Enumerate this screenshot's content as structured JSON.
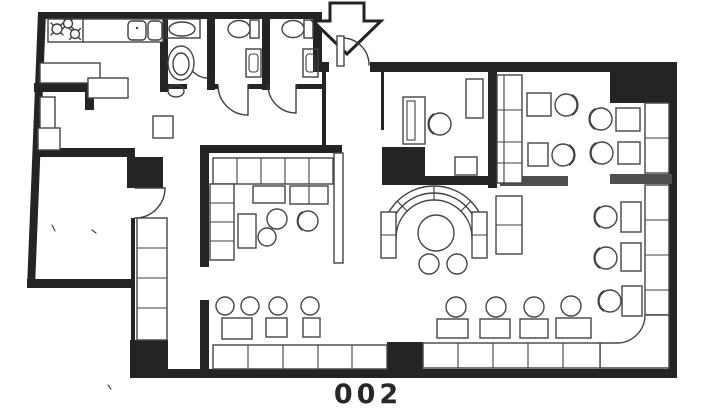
{
  "plan": {
    "label": "002",
    "colors": {
      "paper": "#ffffff",
      "wall": "#242424",
      "line": "#3f3f3f",
      "partition": "#4f4f4f"
    },
    "icons": {
      "entrance_arrow": "entrance-arrow-icon",
      "door": "door-swing-icon",
      "stove": "stove-burner-icon",
      "sink": "sink-icon",
      "toilet": "toilet-icon",
      "washbasin": "washbasin-icon",
      "round_table": "round-table-icon",
      "table": "table-icon",
      "chair": "chair-icon",
      "bench": "bench-seat-icon",
      "booth": "curved-booth-icon"
    }
  }
}
